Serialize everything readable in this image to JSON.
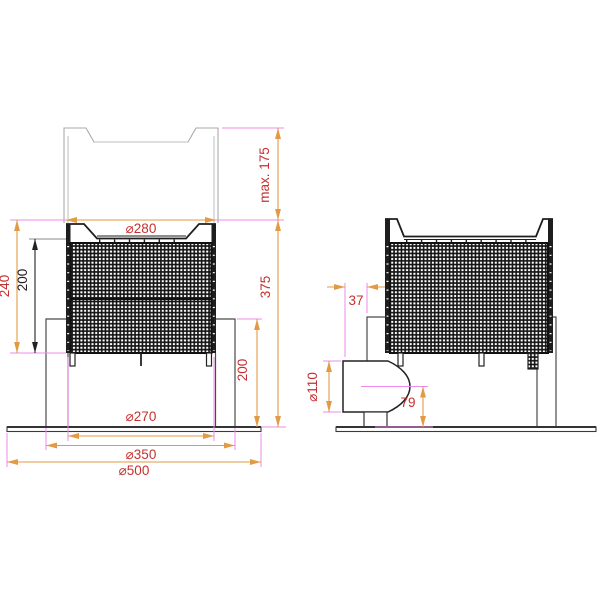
{
  "drawing": {
    "kind": "technical-dimension-drawing",
    "views": {
      "front": {
        "top_diameter": "⌀280",
        "max_lift_height": "max. 175",
        "overall_height": "375",
        "basket_height": "240",
        "screen_height": "200",
        "collar_height": "200",
        "bottom_diameter": "⌀270",
        "collar_diameter": "⌀350",
        "base_diameter": "⌀500"
      },
      "side": {
        "outlet_offset": "37",
        "outlet_diameter": "⌀110",
        "outlet_centre_height": "79"
      }
    },
    "colors": {
      "extension_line": "#ee8aee",
      "dimension_line": "#e39a45",
      "dimension_text": "#c53030",
      "secondary_dimension_text": "#222222",
      "part_outline": "#1e1e1e",
      "ghost_outline": "#a9a9a9"
    }
  }
}
